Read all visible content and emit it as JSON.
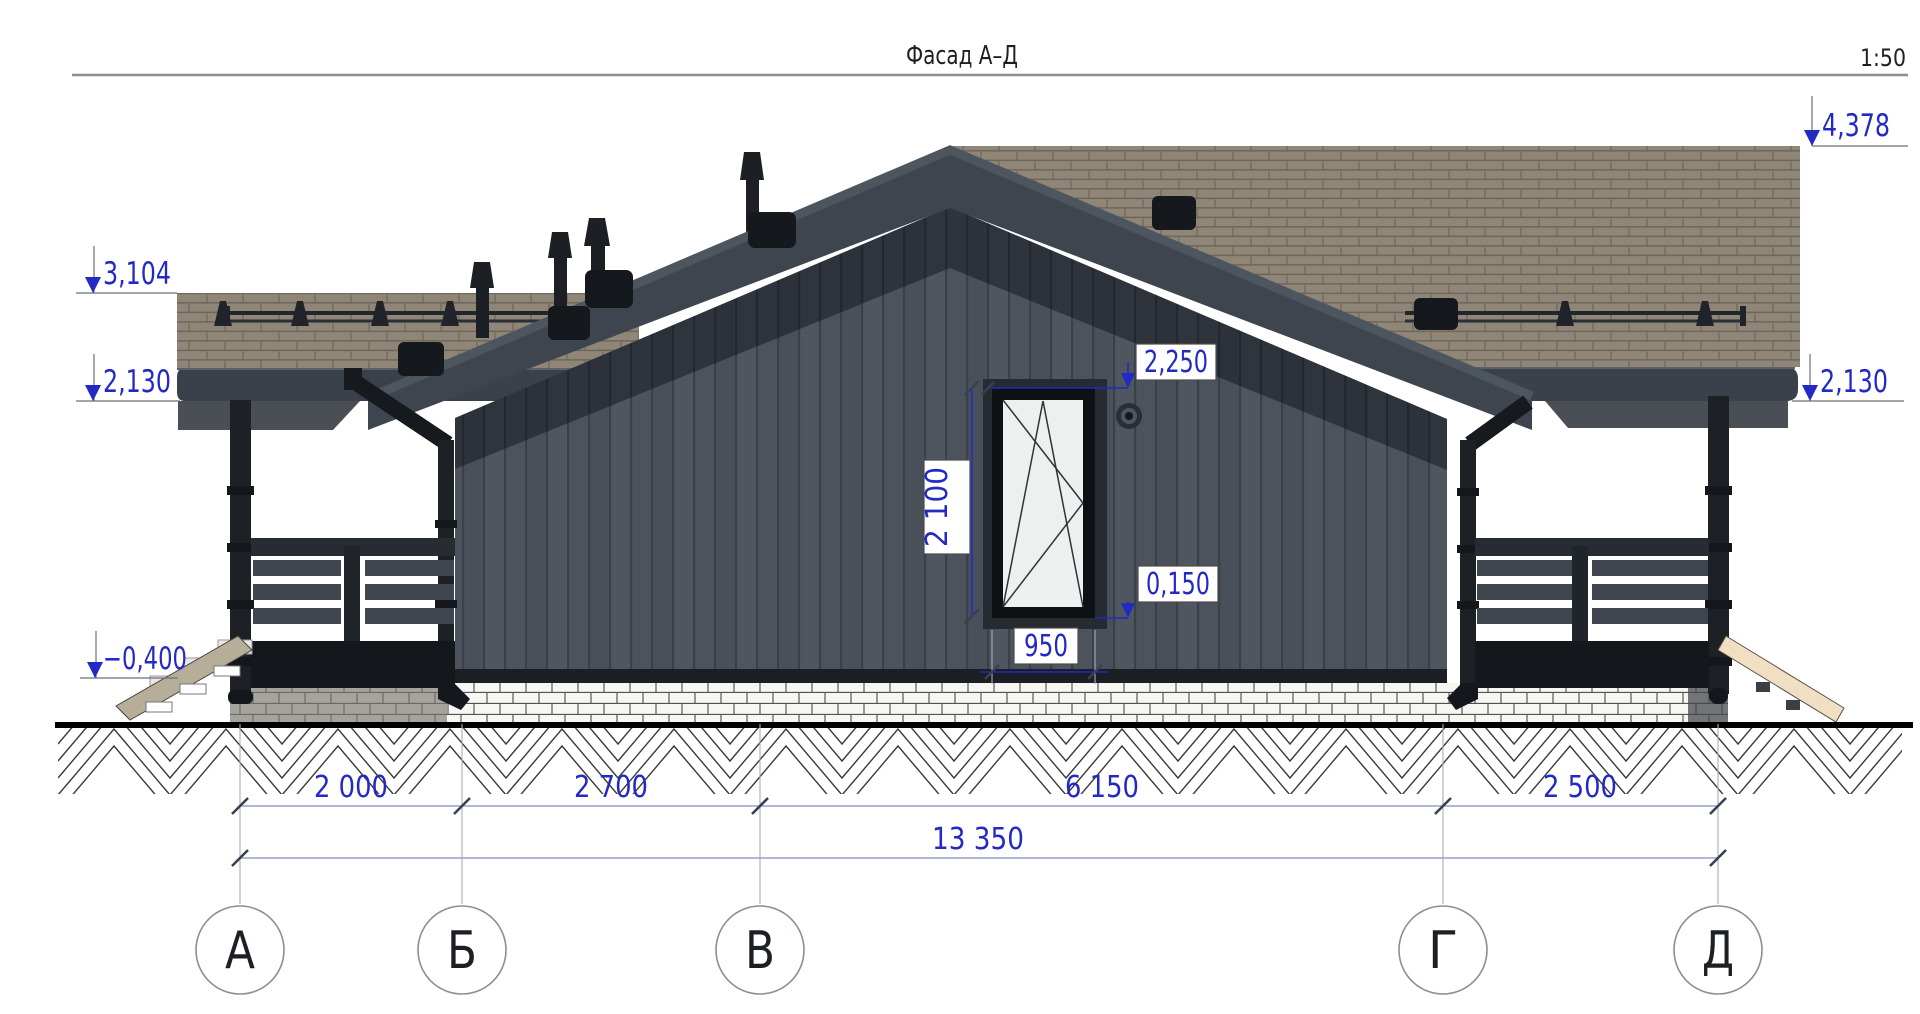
{
  "header": {
    "title": "Фасад А–Д",
    "scale": "1:50"
  },
  "elevations": {
    "ridge": "4,378",
    "left_upper": "3,104",
    "left_eaves": "2,130",
    "right_eaves": "2,130",
    "terrace_floor": "−0,400",
    "window_head": "2,250",
    "window_sill": "0,150"
  },
  "window": {
    "height": "2 100",
    "width": "950"
  },
  "dims": {
    "spans": [
      "2 000",
      "2 700",
      "6 150",
      "2 500"
    ],
    "total": "13 350"
  },
  "axes": {
    "labels": [
      "А",
      "Б",
      "В",
      "Г",
      "Д"
    ]
  },
  "colors": {
    "accent_blue": "#2229c4",
    "siding": "#4c535d",
    "siding_shadow_band": "rgba(5,8,14,0.42)",
    "rake_board": "#3e454f",
    "roof_tile": "#8f8678",
    "brick_white": "#f6f6f3",
    "brick_gray": "#a4a39e",
    "metal_dark": "#1d2126",
    "stair_wood_left": "#b7ae9a",
    "stair_wood_right": "#f0dfc2",
    "glass": "#edf0ee"
  }
}
